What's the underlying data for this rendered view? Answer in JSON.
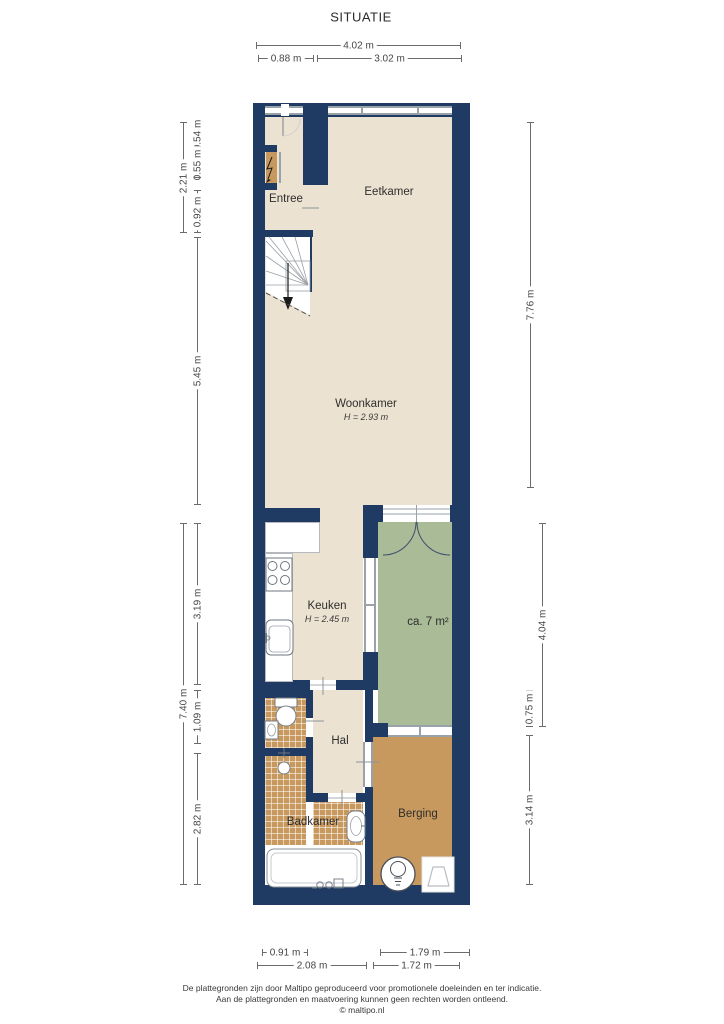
{
  "title": "SITUATIE",
  "rooms": {
    "entree": {
      "label": "Entree"
    },
    "eetkamer": {
      "label": "Eetkamer"
    },
    "woonkamer": {
      "label": "Woonkamer",
      "height": "H = 2.93 m"
    },
    "keuken": {
      "label": "Keuken",
      "height": "H = 2.45 m"
    },
    "terrace": {
      "label": "ca. 7 m²"
    },
    "hal": {
      "label": "Hal"
    },
    "badkamer": {
      "label": "Badkamer"
    },
    "berging": {
      "label": "Berging"
    }
  },
  "dimensions": {
    "top_total": "4.02 m",
    "top_left": "0.88 m",
    "top_right": "3.02 m",
    "left_entree": "2.21 m",
    "left_s1": "0.54 m",
    "left_s2": "0.55 m",
    "left_s3": "0.92 m",
    "left_woonkamer": "5.45 m",
    "left_total_lower": "7.40 m",
    "left_keuken": "3.19 m",
    "left_hal": "1.09 m",
    "left_badkamer": "2.82 m",
    "right_upper": "7.76 m",
    "right_terrace": "4.04 m",
    "right_terrace_inner": "0.75 m",
    "right_berging": "3.14 m",
    "bottom_bad_inner": "0.91 m",
    "bottom_bad": "2.08 m",
    "bottom_berg_inner": "1.79 m",
    "bottom_berg": "1.72 m"
  },
  "footer": {
    "line1": "De plattegronden zijn door Maltipo geproduceerd voor promotionele doeleinden en ter indicatie.",
    "line2": "Aan de plattegronden en maatvoering kunnen geen rechten worden ontleend.",
    "line3": "© maltipo.nl"
  },
  "colors": {
    "wall": "#1f3b63",
    "floor": "#ece2d1",
    "terrace": "#a9bc97",
    "tile": "#c8995e",
    "window_frame": "#9aa2a9",
    "dimension_text": "#454545"
  }
}
